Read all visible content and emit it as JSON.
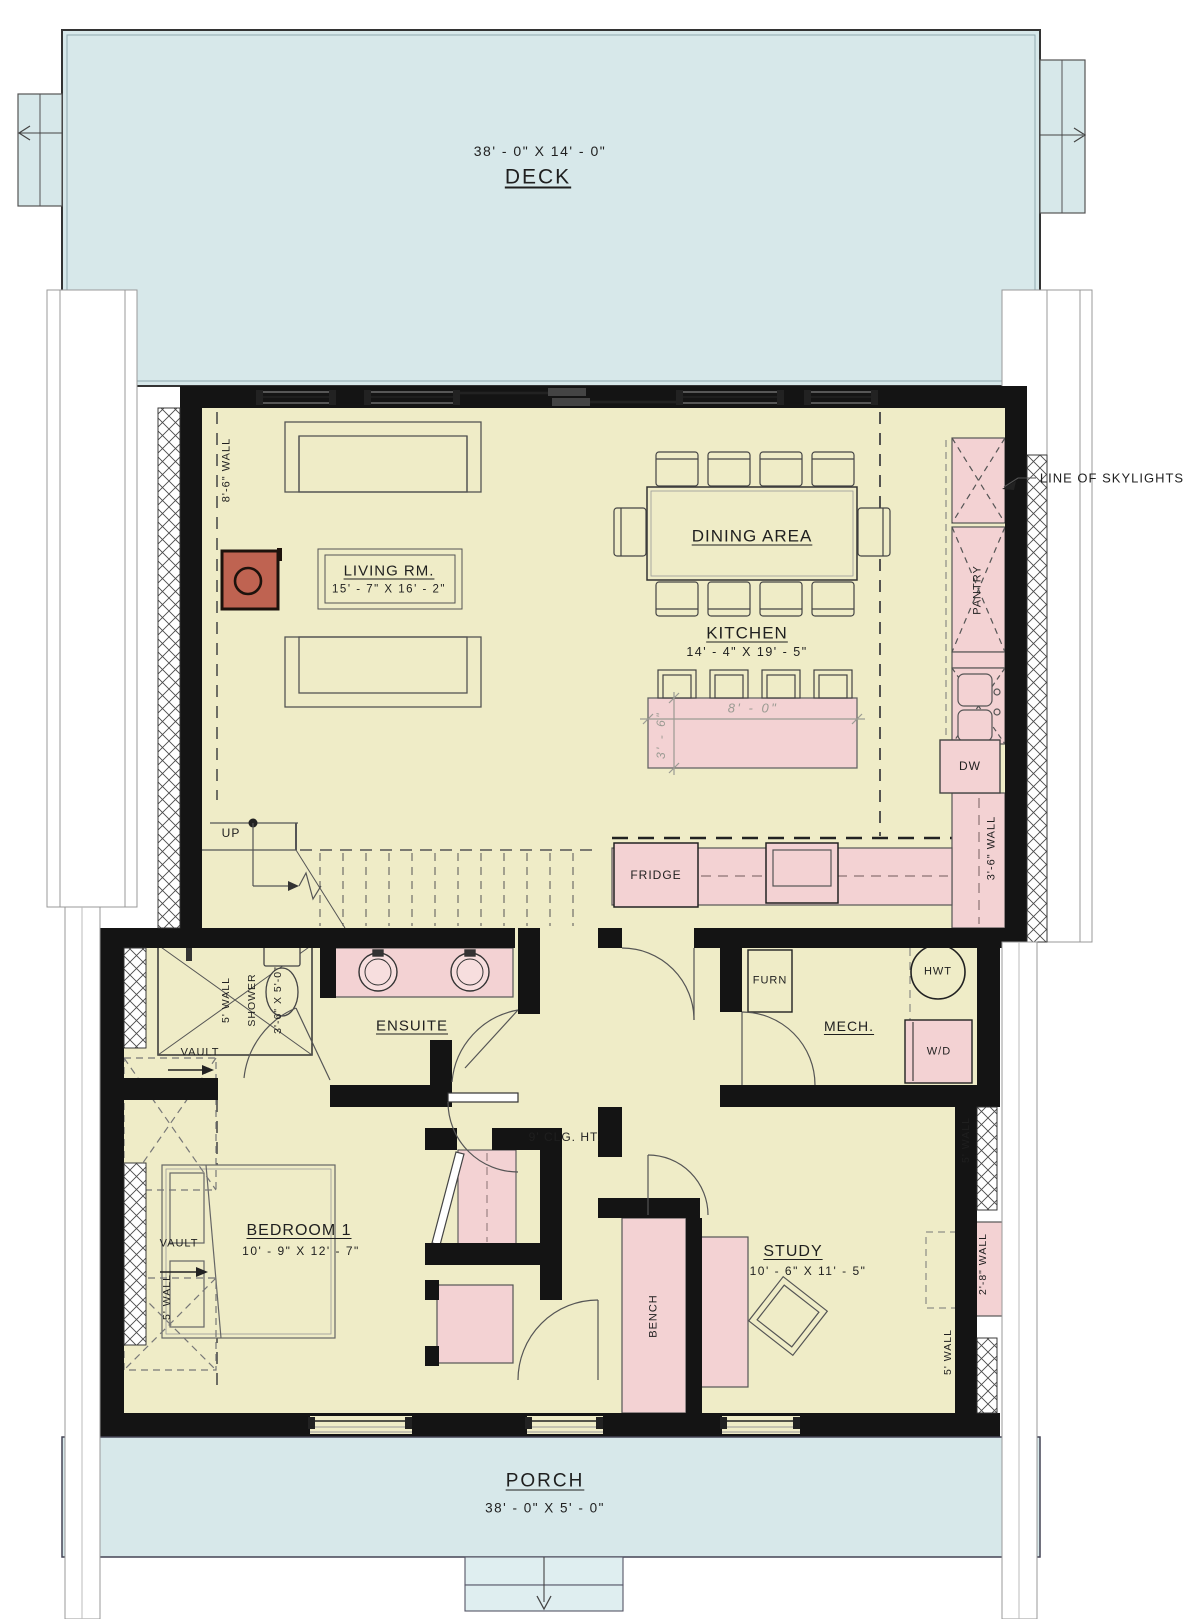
{
  "title": "Main floor plan",
  "colors": {
    "deck_blue": "#d7e8ea",
    "floor_yellow": "#efecc7",
    "cabinet_pink": "#f3d2d3",
    "stove_red": "#bf6351",
    "wall_black": "#141414",
    "line_gray": "#555555",
    "dim_gray": "#9b9b93",
    "paper_white": "#ffffff"
  },
  "labels": {
    "deck": "DECK",
    "deck_dims": "38' - 0\" X 14' - 0\"",
    "skylights": "LINE OF SKYLIGHTS",
    "wall86": "8'-6\" WALL",
    "living": "LIVING RM.",
    "living_dims": "15' - 7\" X 16' - 2\"",
    "dining": "DINING AREA",
    "kitchen": "KITCHEN",
    "kitchen_dims": "14' - 4\" X 19' - 5\"",
    "pantry": "PANTRY",
    "island_w": "8' - 0\"",
    "island_d": "3' - 6\"",
    "dw": "DW",
    "wall36": "3'-6\" WALL",
    "up": "UP",
    "fridge": "FRIDGE",
    "ensuite": "ENSUITE",
    "wall5": "5' WALL",
    "shower": "SHOWER",
    "shower_dims": "3'-6\" X 5'-0\"",
    "vault": "VAULT",
    "furn": "FURN",
    "hwt": "HWT",
    "mech": "MECH.",
    "wd": "W/D",
    "clg": "9' CLG. HT.",
    "bedroom": "BEDROOM 1",
    "bedroom_dims": "10' - 9\" X 12' - 7\"",
    "bench": "BENCH",
    "study": "STUDY",
    "study_dims": "10' - 6\" X 11' - 5\"",
    "wall28": "2'-8\" WALL",
    "porch": "PORCH",
    "porch_dims": "38' - 0\" X 5' - 0\""
  }
}
